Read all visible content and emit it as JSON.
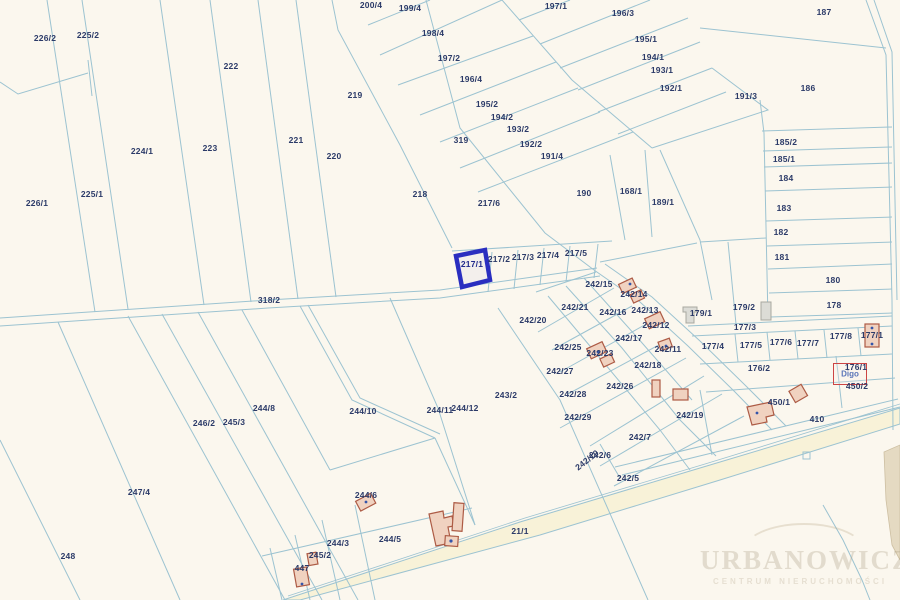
{
  "map": {
    "type": "cadastral-parcel-map",
    "selected_parcel": "217/1",
    "colors": {
      "background": "#fbf7ee",
      "parcel_line": "#9cc3d1",
      "label_text": "#2b3a68",
      "highlight": "#2a2ec0",
      "building_fill": "#f0d2c0",
      "building_stroke": "#ad5b45",
      "gray_building_fill": "#dcdcd6",
      "road_fill": "#f8f2d8",
      "annotation_box": "#c44444"
    },
    "watermark": {
      "line1": "URBANOWICZ",
      "line2": "CENTRUM NIERUCHOMOŚCI"
    },
    "annotation": {
      "text": "Digo"
    },
    "labels": [
      {
        "text": "226/2",
        "x": 45,
        "y": 38
      },
      {
        "text": "225/2",
        "x": 88,
        "y": 35
      },
      {
        "text": "222",
        "x": 231,
        "y": 66
      },
      {
        "text": "221",
        "x": 296,
        "y": 140
      },
      {
        "text": "220",
        "x": 334,
        "y": 156
      },
      {
        "text": "219",
        "x": 355,
        "y": 95
      },
      {
        "text": "224/1",
        "x": 142,
        "y": 151
      },
      {
        "text": "223",
        "x": 210,
        "y": 148
      },
      {
        "text": "225/1",
        "x": 92,
        "y": 194
      },
      {
        "text": "226/1",
        "x": 37,
        "y": 203
      },
      {
        "text": "200/4",
        "x": 371,
        "y": 5
      },
      {
        "text": "199/4",
        "x": 410,
        "y": 8
      },
      {
        "text": "198/4",
        "x": 433,
        "y": 33
      },
      {
        "text": "197/2",
        "x": 449,
        "y": 58
      },
      {
        "text": "196/4",
        "x": 471,
        "y": 79
      },
      {
        "text": "195/2",
        "x": 487,
        "y": 104
      },
      {
        "text": "194/2",
        "x": 502,
        "y": 117
      },
      {
        "text": "193/2",
        "x": 518,
        "y": 129
      },
      {
        "text": "192/2",
        "x": 531,
        "y": 144
      },
      {
        "text": "191/4",
        "x": 552,
        "y": 156
      },
      {
        "text": "319",
        "x": 461,
        "y": 140
      },
      {
        "text": "197/1",
        "x": 556,
        "y": 6
      },
      {
        "text": "196/3",
        "x": 623,
        "y": 13
      },
      {
        "text": "195/1",
        "x": 646,
        "y": 39
      },
      {
        "text": "194/1",
        "x": 653,
        "y": 57
      },
      {
        "text": "193/1",
        "x": 662,
        "y": 70
      },
      {
        "text": "192/1",
        "x": 671,
        "y": 88
      },
      {
        "text": "191/3",
        "x": 746,
        "y": 96
      },
      {
        "text": "187",
        "x": 824,
        "y": 12
      },
      {
        "text": "186",
        "x": 808,
        "y": 88
      },
      {
        "text": "185/2",
        "x": 786,
        "y": 142
      },
      {
        "text": "185/1",
        "x": 784,
        "y": 159
      },
      {
        "text": "184",
        "x": 786,
        "y": 178
      },
      {
        "text": "183",
        "x": 784,
        "y": 208
      },
      {
        "text": "182",
        "x": 781,
        "y": 232
      },
      {
        "text": "181",
        "x": 782,
        "y": 257
      },
      {
        "text": "180",
        "x": 833,
        "y": 280
      },
      {
        "text": "178",
        "x": 834,
        "y": 305
      },
      {
        "text": "190",
        "x": 584,
        "y": 193
      },
      {
        "text": "168/1",
        "x": 631,
        "y": 191
      },
      {
        "text": "189/1",
        "x": 663,
        "y": 202
      },
      {
        "text": "218",
        "x": 420,
        "y": 194
      },
      {
        "text": "217/6",
        "x": 489,
        "y": 203
      },
      {
        "text": "318/2",
        "x": 269,
        "y": 300
      },
      {
        "text": "217/1",
        "x": 472,
        "y": 264,
        "selected": true
      },
      {
        "text": "217/2",
        "x": 499,
        "y": 259
      },
      {
        "text": "217/3",
        "x": 523,
        "y": 257
      },
      {
        "text": "217/4",
        "x": 548,
        "y": 255
      },
      {
        "text": "217/5",
        "x": 576,
        "y": 253
      },
      {
        "text": "242/15",
        "x": 599,
        "y": 284
      },
      {
        "text": "242/14",
        "x": 634,
        "y": 294
      },
      {
        "text": "242/21",
        "x": 575,
        "y": 307
      },
      {
        "text": "242/16",
        "x": 613,
        "y": 312
      },
      {
        "text": "242/13",
        "x": 645,
        "y": 310
      },
      {
        "text": "242/12",
        "x": 656,
        "y": 325
      },
      {
        "text": "242/20",
        "x": 533,
        "y": 320
      },
      {
        "text": "242/17",
        "x": 629,
        "y": 338
      },
      {
        "text": "242/25",
        "x": 568,
        "y": 347
      },
      {
        "text": "242/23",
        "x": 600,
        "y": 353
      },
      {
        "text": "242/11",
        "x": 668,
        "y": 349
      },
      {
        "text": "242/18",
        "x": 648,
        "y": 365
      },
      {
        "text": "242/27",
        "x": 560,
        "y": 371
      },
      {
        "text": "242/26",
        "x": 620,
        "y": 386
      },
      {
        "text": "242/28",
        "x": 573,
        "y": 394
      },
      {
        "text": "242/29",
        "x": 578,
        "y": 417
      },
      {
        "text": "242/7",
        "x": 640,
        "y": 437
      },
      {
        "text": "242/6",
        "x": 600,
        "y": 455
      },
      {
        "text": "242/10",
        "x": 587,
        "y": 460,
        "rot": -38
      },
      {
        "text": "242/5",
        "x": 628,
        "y": 478
      },
      {
        "text": "242/19",
        "x": 690,
        "y": 415
      },
      {
        "text": "243/2",
        "x": 506,
        "y": 395
      },
      {
        "text": "244/11",
        "x": 440,
        "y": 410
      },
      {
        "text": "244/12",
        "x": 465,
        "y": 408
      },
      {
        "text": "244/10",
        "x": 363,
        "y": 411
      },
      {
        "text": "244/8",
        "x": 264,
        "y": 408
      },
      {
        "text": "246/2",
        "x": 204,
        "y": 423
      },
      {
        "text": "245/3",
        "x": 234,
        "y": 422
      },
      {
        "text": "247/4",
        "x": 139,
        "y": 492
      },
      {
        "text": "248",
        "x": 68,
        "y": 556
      },
      {
        "text": "244/6",
        "x": 366,
        "y": 495
      },
      {
        "text": "244/5",
        "x": 390,
        "y": 539
      },
      {
        "text": "244/3",
        "x": 338,
        "y": 543
      },
      {
        "text": "245/2",
        "x": 320,
        "y": 555
      },
      {
        "text": "447",
        "x": 302,
        "y": 568
      },
      {
        "text": "21/1",
        "x": 520,
        "y": 531
      },
      {
        "text": "410",
        "x": 817,
        "y": 419
      },
      {
        "text": "450/1",
        "x": 779,
        "y": 402
      },
      {
        "text": "450/2",
        "x": 857,
        "y": 386
      },
      {
        "text": "176/1",
        "x": 856,
        "y": 367
      },
      {
        "text": "176/2",
        "x": 759,
        "y": 368
      },
      {
        "text": "179/1",
        "x": 701,
        "y": 313
      },
      {
        "text": "179/2",
        "x": 744,
        "y": 307
      },
      {
        "text": "177/3",
        "x": 745,
        "y": 327
      },
      {
        "text": "177/4",
        "x": 713,
        "y": 346
      },
      {
        "text": "177/5",
        "x": 751,
        "y": 345
      },
      {
        "text": "177/6",
        "x": 781,
        "y": 342
      },
      {
        "text": "177/7",
        "x": 808,
        "y": 343
      },
      {
        "text": "177/8",
        "x": 841,
        "y": 336
      },
      {
        "text": "177/1",
        "x": 872,
        "y": 335
      }
    ]
  }
}
